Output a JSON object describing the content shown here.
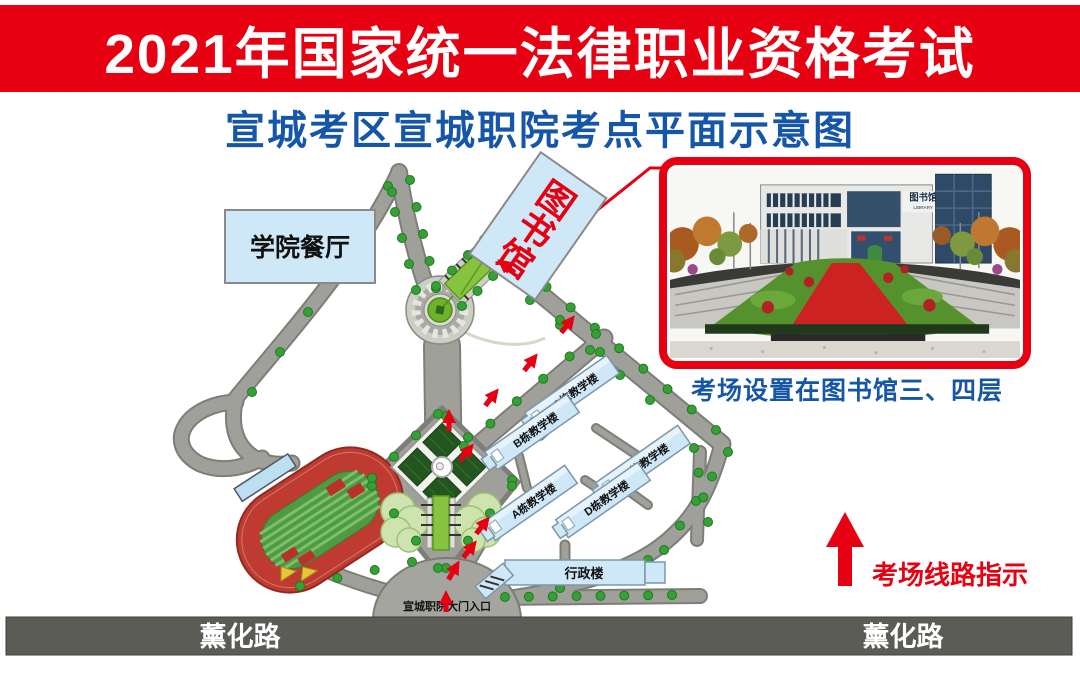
{
  "banner": {
    "title": "2021年国家统一法律职业资格考试"
  },
  "subtitle": {
    "text": "宣城考区宣城职院考点平面示意图"
  },
  "map": {
    "cafeteria_label": "学院餐厅",
    "library_label": "图书馆",
    "library_chars": [
      "图",
      "书",
      "馆"
    ],
    "buildings": [
      {
        "id": "C",
        "label": "C栋教学楼"
      },
      {
        "id": "B",
        "label": "B栋教学楼"
      },
      {
        "id": "E",
        "label": "E栋教学楼"
      },
      {
        "id": "A",
        "label": "A栋教学楼"
      },
      {
        "id": "D",
        "label": "D栋教学楼"
      }
    ],
    "admin_label": "行政楼",
    "gate_label": "宣城职院大门入口",
    "road_label_left": "薰化路",
    "road_label_right": "薰化路"
  },
  "inset": {
    "caption": "考场设置在图书馆三、四层",
    "building_sign": "图书馆",
    "building_sign_en": "LIBRARY"
  },
  "legend": {
    "route_label": "考场线路指示"
  },
  "colors": {
    "accentRed": "#e60012",
    "titleBlue": "#1656a8",
    "roadFill": "#a0a09a",
    "roadEdge": "#7e7e78",
    "roadDarkBar": "#5c5c57",
    "buildingFill": "#cfe8f7",
    "buildingEdge": "#7d97a8",
    "treeGreen": "#35a035",
    "rampGreen": "#86c440",
    "fieldGreen": "#4f9a43",
    "trackRed": "#bf3a30",
    "plazaGreenDark": "#23561f",
    "plazaGreenLight": "#cfe3ae"
  }
}
